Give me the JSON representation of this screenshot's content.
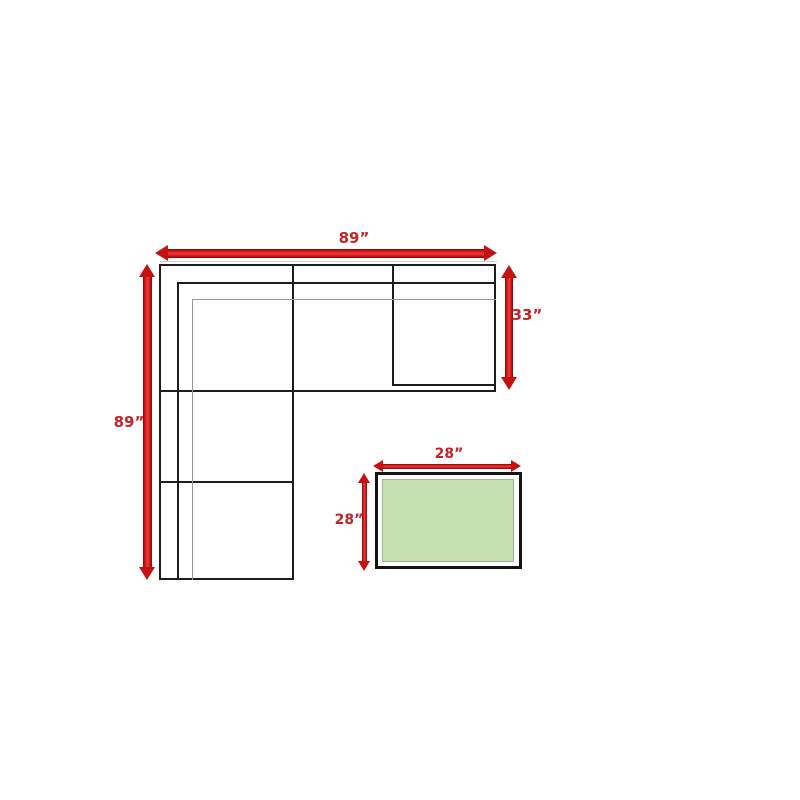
{
  "diagram": {
    "kind": "sectional-sofa-dimension-diagram",
    "colors": {
      "background": "#ffffff",
      "outline_black": "#1d1d1d",
      "detail_gray": "#9a9a9a",
      "arrow_red": "#c41212",
      "label_red": "#c2242a",
      "ottoman_green": "#c7e0b2"
    },
    "sofa": {
      "name": "L-shaped sectional sofa, top view",
      "width_label": "89”",
      "length_label": "89”",
      "depth_label": "33”"
    },
    "ottoman": {
      "name": "ottoman table, top view",
      "width_label": "28”",
      "depth_label": "28”"
    }
  }
}
